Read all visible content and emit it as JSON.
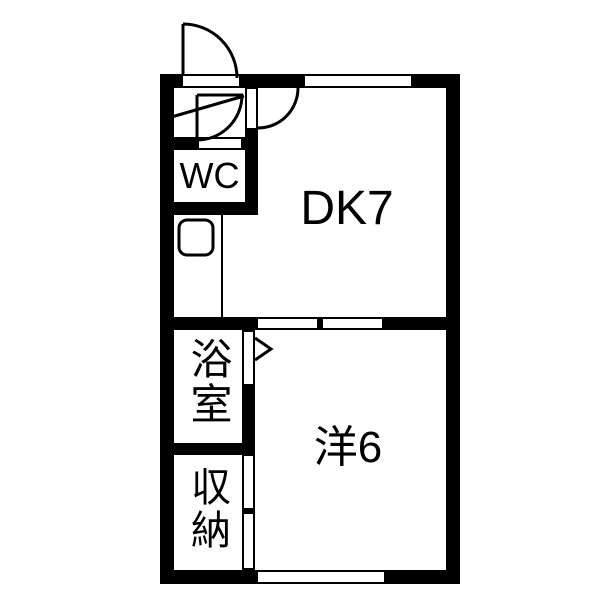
{
  "diagram": {
    "type": "apartment-floor-plan",
    "rooms": {
      "dining_kitchen": {
        "label": "DK7"
      },
      "western_room": {
        "label": "洋6"
      },
      "toilet": {
        "label": "WC"
      },
      "bathroom": {
        "label": "浴室"
      },
      "storage": {
        "label": "収納"
      }
    },
    "fixtures": {
      "entrance_door": "swing-door",
      "hall_dk_door": "swing-door",
      "toilet_door": "swing-door",
      "bathroom_door": "chevron-door",
      "dk_western_partition": "double-sliding-door",
      "storage_doors": "double-sliding-door",
      "windows": [
        "top-window",
        "bottom-window"
      ],
      "sink": "rounded-basin",
      "entrance_step": "diagonal-line"
    },
    "colors": {
      "wall": "#000000",
      "floor": "#ffffff",
      "line": "#000000"
    }
  }
}
